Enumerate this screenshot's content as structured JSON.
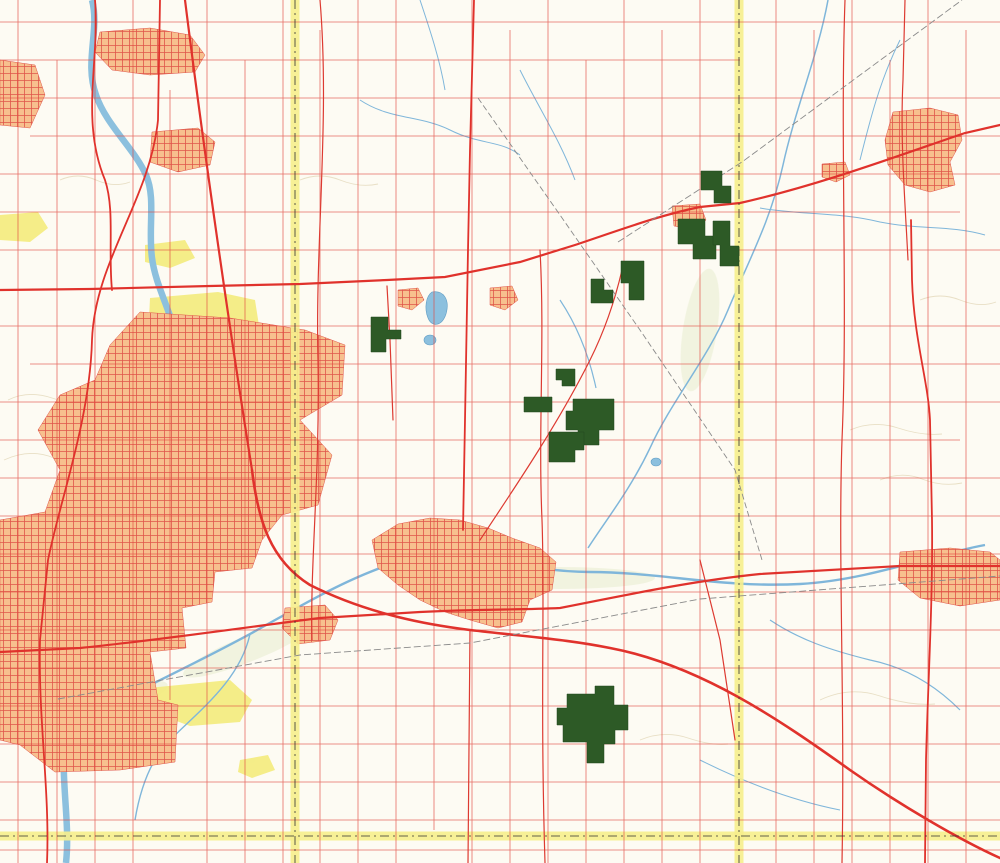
{
  "map": {
    "colors": {
      "arrow_fill": "#b7d455",
      "arrow_text": "#2d7a1e",
      "tract_fill": "#2d5a26",
      "county_band": "#f6ee8c",
      "road_minor": "#e2463e",
      "urban": "#f7c08e",
      "water": "#7fb6da",
      "park": "#f4ec7f",
      "interstate_blue": "#1d7fc4",
      "interstate_red": "#d6362b"
    },
    "arrows": [
      {
        "id": "tracts-40-48",
        "label": "Tracts 40-48",
        "x1": 520,
        "y1": 162,
        "x2": 733,
        "y2": 252,
        "lx": 597,
        "ly": 193,
        "rot": 23
      },
      {
        "id": "tracts-33-39",
        "label": "Tracts 33-39",
        "x1": 452,
        "y1": 192,
        "x2": 598,
        "y2": 283,
        "lx": 504,
        "ly": 226,
        "rot": 32
      },
      {
        "id": "tracts-30-32",
        "label": "Tracts 30-32",
        "x1": 212,
        "y1": 328,
        "x2": 548,
        "y2": 338,
        "lx": 296,
        "ly": 334,
        "rot": 1.5
      },
      {
        "id": "tracts-15-29",
        "label": "Tracts 15-29",
        "x1": 430,
        "y1": 302,
        "x2": 557,
        "y2": 400,
        "lx": 474,
        "ly": 341,
        "rot": 38
      },
      {
        "id": "auction",
        "label": "Auction",
        "x1": 352,
        "y1": 708,
        "x2": 483,
        "y2": 576,
        "lx": 401,
        "ly": 654,
        "rot": -45,
        "big": true
      },
      {
        "id": "tracts-1-14",
        "label": "Tracts 1-14",
        "x1": 406,
        "y1": 699,
        "x2": 560,
        "y2": 706,
        "lx": 463,
        "ly": 702,
        "rot": 2
      }
    ],
    "towns": [
      {
        "t": "Rockton",
        "x": 173,
        "y": 54,
        "c": "town"
      },
      {
        "t": "Roscoe",
        "x": 176,
        "y": 150,
        "c": "town"
      },
      {
        "t": "Morehaven",
        "x": 139,
        "y": 131,
        "c": "town-sm"
      },
      {
        "t": "Argyle",
        "x": 308,
        "y": 301,
        "c": "town-sm"
      },
      {
        "t": "Caledonia",
        "x": 387,
        "y": 276,
        "c": "town-big"
      },
      {
        "t": "Poplar Grove",
        "x": 501,
        "y": 281,
        "c": "town-sm"
      },
      {
        "t": "Capron",
        "x": 684,
        "y": 208,
        "c": "town-big"
      },
      {
        "t": "Harvard",
        "x": 947,
        "y": 123,
        "c": "town-md"
      },
      {
        "t": "Chemung",
        "x": 839,
        "y": 160,
        "c": "town-sm"
      },
      {
        "t": "Lawrence",
        "x": 880,
        "y": 99,
        "c": "town-sm"
      },
      {
        "t": "Machesney\nPark",
        "x": 90,
        "y": 336,
        "c": "town-md"
      },
      {
        "t": "Loves Park",
        "x": 97,
        "y": 401,
        "c": "town-md"
      },
      {
        "t": "ROCKFORD",
        "x": 67,
        "y": 530,
        "c": "city"
      },
      {
        "t": "Belvidere",
        "x": 442,
        "y": 531,
        "c": "city-sans"
      },
      {
        "t": "Cherry Valley",
        "x": 306,
        "y": 622,
        "c": "town-md"
      },
      {
        "t": "New\nMilford",
        "x": 55,
        "y": 737,
        "c": "town-md"
      },
      {
        "t": "Kishwaukee\nGlen",
        "x": 154,
        "y": 741,
        "c": "town-sm"
      },
      {
        "t": "Morristown",
        "x": 88,
        "y": 780,
        "c": "town-sm"
      },
      {
        "t": "Garden\nPrairie",
        "x": 727,
        "y": 588,
        "c": "town-sm"
      },
      {
        "t": "Camp\nEpworth",
        "x": 644,
        "y": 589,
        "c": "town-sm"
      },
      {
        "t": "Marengo",
        "x": 961,
        "y": 585,
        "c": "town-md"
      },
      {
        "t": "Russellville",
        "x": 608,
        "y": 390,
        "c": "micro"
      },
      {
        "t": "Blaine",
        "x": 566,
        "y": 77,
        "c": "micro"
      },
      {
        "t": "Perryville",
        "x": 235,
        "y": 658,
        "c": "micro"
      }
    ],
    "townships": [
      {
        "t": "ROSCOE",
        "x": 238,
        "y": 60
      },
      {
        "t": "MANCHESTER",
        "x": 425,
        "y": 45
      },
      {
        "t": "LEROY",
        "x": 628,
        "y": 63
      },
      {
        "t": "CHEMUNG",
        "x": 862,
        "y": 50
      },
      {
        "t": "CALEDONIA",
        "x": 376,
        "y": 231
      },
      {
        "t": "POPLAR\nGROVE",
        "x": 500,
        "y": 253
      },
      {
        "t": "DUNHAM",
        "x": 865,
        "y": 282
      },
      {
        "t": "HARLEM",
        "x": 168,
        "y": 271
      },
      {
        "t": "ROCKFORD",
        "x": 109,
        "y": 431
      },
      {
        "t": "BELVIDERE",
        "x": 448,
        "y": 503
      },
      {
        "t": "BONUS",
        "x": 637,
        "y": 493
      },
      {
        "t": "MARENGO",
        "x": 840,
        "y": 477
      },
      {
        "t": "CHERRY",
        "x": 127,
        "y": 688
      },
      {
        "t": "VALLEY",
        "x": 229,
        "y": 688
      },
      {
        "t": "SPRING",
        "x": 643,
        "y": 682
      },
      {
        "t": "RILEY",
        "x": 832,
        "y": 682
      },
      {
        "t": "BOONE",
        "x": 677,
        "y": 284
      }
    ],
    "counties": [
      {
        "t": "WINNEBAGO CO",
        "x": 240,
        "y": 832,
        "r": 0
      },
      {
        "t": "OGLE CO",
        "x": 227,
        "y": 844,
        "r": 0
      },
      {
        "t": "BOONE CO",
        "x": 352,
        "y": 831,
        "r": 0
      },
      {
        "t": "DE KALB CO",
        "x": 353,
        "y": 843,
        "r": 0
      },
      {
        "t": "DE KALB CO",
        "x": 747,
        "y": 843,
        "r": 0
      },
      {
        "t": "WINNEBAGO CO",
        "x": 288,
        "y": 40,
        "r": 90
      },
      {
        "t": "BOONE CO",
        "x": 304,
        "y": 36,
        "r": 90
      },
      {
        "t": "WINNEBAGO CO",
        "x": 290,
        "y": 680,
        "r": 90
      },
      {
        "t": "BOONE CO",
        "x": 304,
        "y": 678,
        "r": 90
      },
      {
        "t": "BOONE CO",
        "x": 732,
        "y": 22,
        "r": 90
      },
      {
        "t": "MC HENRY CO",
        "x": 748,
        "y": 26,
        "r": 90
      },
      {
        "t": "BOONE CO",
        "x": 736,
        "y": 806,
        "r": 90
      },
      {
        "t": "MC HENRY CO",
        "x": 750,
        "y": 807,
        "r": 90
      }
    ],
    "road_labels": [
      {
        "t": "MANCHESTER RD",
        "x": 489,
        "y": 14
      },
      {
        "t": "COON TRAIL RD",
        "x": 578,
        "y": 12
      },
      {
        "t": "RANDALL RD",
        "x": 690,
        "y": 50
      },
      {
        "t": "BLAINE RD",
        "x": 650,
        "y": 92
      },
      {
        "t": "ROCKTON RD",
        "x": 407,
        "y": 58
      },
      {
        "t": "ELEVATOR RD",
        "x": 259,
        "y": 124
      },
      {
        "t": "WEST LANE RD",
        "x": 262,
        "y": 272
      },
      {
        "t": "CEMETERY RD",
        "x": 713,
        "y": 218
      },
      {
        "t": "BUNKER HILL RD",
        "x": 837,
        "y": 308
      },
      {
        "t": "DUNHAM RD",
        "x": 758,
        "y": 353
      },
      {
        "t": "GRANGE HALL RD",
        "x": 612,
        "y": 365
      },
      {
        "t": "ORTH RD",
        "x": 698,
        "y": 384
      },
      {
        "t": "WOODSTOCK RD",
        "x": 543,
        "y": 430
      },
      {
        "t": "SQUAW PRAIRIE RD",
        "x": 600,
        "y": 478
      },
      {
        "t": "CHRYSLER DR",
        "x": 692,
        "y": 603
      },
      {
        "t": "FERN HILL RD",
        "x": 708,
        "y": 651
      },
      {
        "t": "JACKSON RD",
        "x": 760,
        "y": 666
      },
      {
        "t": "HUBER RD",
        "x": 639,
        "y": 718
      },
      {
        "t": "W ANTHONY RD",
        "x": 930,
        "y": 739
      },
      {
        "t": "HARMONY RD",
        "x": 763,
        "y": 758
      },
      {
        "t": "ENGELSON RD",
        "x": 680,
        "y": 776
      },
      {
        "t": "BLOODS POINT RD",
        "x": 476,
        "y": 776
      },
      {
        "t": "POOLE RD",
        "x": 430,
        "y": 747
      },
      {
        "t": "DAVIS SCHOOL RD",
        "x": 515,
        "y": 793
      },
      {
        "t": "HARTMAN RD",
        "x": 838,
        "y": 790
      },
      {
        "t": "FLORA CHURCH RD",
        "x": 358,
        "y": 815
      },
      {
        "t": "POPLAR RD",
        "x": 580,
        "y": 830
      },
      {
        "t": "POPLAR RD",
        "x": 893,
        "y": 832
      },
      {
        "t": "AIRPORT RD",
        "x": 893,
        "y": 179
      },
      {
        "t": "HANER RD",
        "x": 864,
        "y": 147
      },
      {
        "t": "TOWN LINE RD",
        "x": 298,
        "y": 107,
        "r": 90
      },
      {
        "t": "POPLAR GROVE RD",
        "x": 527,
        "y": 185,
        "r": 90
      },
      {
        "t": "GENOA RD",
        "x": 548,
        "y": 678,
        "r": 90
      },
      {
        "t": "COUNTY LINE RD",
        "x": 736,
        "y": 713,
        "r": 90
      },
      {
        "t": "UNION PACIFIC",
        "x": 163,
        "y": 646,
        "r": -8
      }
    ],
    "water_labels": [
      {
        "t": "Piscasaw Creek",
        "x": 766,
        "y": 196,
        "r": -62
      },
      {
        "t": "Rush Creek",
        "x": 851,
        "y": 390,
        "r": -72
      },
      {
        "t": "Candlewick\nLake",
        "x": 459,
        "y": 304
      },
      {
        "t": "County\nLake",
        "x": 430,
        "y": 353
      },
      {
        "t": "River",
        "x": 578,
        "y": 572
      }
    ],
    "place_labels": [
      {
        "t": "ROCK CUT\nSTATE PARK",
        "x": 203,
        "y": 306
      },
      {
        "t": "KISHWAUKEE\nFOREST PRESERVE",
        "x": 210,
        "y": 743
      },
      {
        "t": "ATWOOD HOMESTEAD\nFOREST PRESERVE",
        "x": 38,
        "y": 233
      },
      {
        "t": "KIESELBURG\nFOREST PRESERVE",
        "x": 164,
        "y": 257
      },
      {
        "t": "Hutchins\nPark",
        "x": 24,
        "y": 258
      },
      {
        "t": "Latham\nPark",
        "x": 27,
        "y": 285
      },
      {
        "t": "Pierce\nLake",
        "x": 204,
        "y": 327
      },
      {
        "t": "The Time\nMuseum",
        "x": 281,
        "y": 534
      },
      {
        "t": "Ida Belle Farm\nLanding Strip",
        "x": 197,
        "y": 192
      },
      {
        "t": "Landing\nStrip",
        "x": 687,
        "y": 25
      },
      {
        "t": "Landing\nStrip",
        "x": 922,
        "y": 754
      },
      {
        "t": "Belvidere\nAirport",
        "x": 506,
        "y": 392
      },
      {
        "t": "Dacy\nAirport",
        "x": 880,
        "y": 192
      }
    ],
    "icons": [
      {
        "g": "✈",
        "x": 497,
        "y": 383,
        "n": "airport-icon"
      },
      {
        "g": "✈",
        "x": 876,
        "y": 184,
        "n": "airport-icon"
      },
      {
        "g": "✈",
        "x": 706,
        "y": 566,
        "n": "airport-icon"
      }
    ],
    "shields": [
      {
        "kind": "interstate",
        "num": "90",
        "x": 252,
        "y": 491,
        "s": 1
      },
      {
        "kind": "interstate",
        "num": "90",
        "x": 627,
        "y": 651,
        "s": 1.05
      },
      {
        "kind": "interstate",
        "num": "39",
        "x": 195,
        "y": 15,
        "s": 0.55
      },
      {
        "kind": "interstate",
        "num": "90",
        "x": 195,
        "y": 37,
        "s": 0.55
      },
      {
        "kind": "interstate",
        "num": "39",
        "x": 236,
        "y": 234,
        "s": 0.5
      },
      {
        "kind": "interstate",
        "num": "90",
        "x": 238,
        "y": 248,
        "s": 0.5
      },
      {
        "kind": "interstate",
        "num": "39",
        "x": 250,
        "y": 536,
        "s": 0.5
      },
      {
        "kind": "interstate",
        "num": "90",
        "x": 250,
        "y": 548,
        "s": 0.5
      },
      {
        "kind": "interstate",
        "num": "39",
        "x": 137,
        "y": 755,
        "s": 0.5
      },
      {
        "kind": "us",
        "num": "51",
        "x": 196,
        "y": 57,
        "s": 0.62
      },
      {
        "kind": "us",
        "num": "51",
        "x": 242,
        "y": 263,
        "s": 0.6
      },
      {
        "kind": "us",
        "num": "51",
        "x": 251,
        "y": 561,
        "s": 0.6
      },
      {
        "kind": "us",
        "num": "51",
        "x": 137,
        "y": 771,
        "s": 0.6
      },
      {
        "kind": "us",
        "num": "20",
        "x": 393,
        "y": 612,
        "s": 1
      },
      {
        "kind": "us",
        "num": "20",
        "x": 343,
        "y": 521,
        "s": 0.7
      },
      {
        "kind": "us",
        "num": "20",
        "x": 705,
        "y": 577,
        "s": 0.8
      },
      {
        "kind": "us",
        "num": "20",
        "x": 218,
        "y": 658,
        "s": 0.6
      },
      {
        "kind": "us",
        "num": "20",
        "x": 968,
        "y": 803,
        "s": 0.6
      },
      {
        "kind": "oval",
        "num": "173",
        "x": 445,
        "y": 277,
        "s": 1
      },
      {
        "kind": "oval",
        "num": "173",
        "x": 722,
        "y": 200,
        "s": 1
      },
      {
        "kind": "oval",
        "num": "173",
        "x": 975,
        "y": 130,
        "s": 1
      },
      {
        "kind": "oval",
        "num": "173",
        "x": 128,
        "y": 288,
        "s": 1
      },
      {
        "kind": "oval",
        "num": "76",
        "x": 470,
        "y": 230,
        "s": 0.9
      },
      {
        "kind": "oval",
        "num": "76",
        "x": 466,
        "y": 492,
        "s": 0.9
      },
      {
        "kind": "oval",
        "num": "251",
        "x": 158,
        "y": 207,
        "s": 0.95
      },
      {
        "kind": "oval",
        "num": "251",
        "x": 86,
        "y": 418,
        "s": 0.9
      },
      {
        "kind": "oval",
        "num": "251",
        "x": 45,
        "y": 632,
        "s": 0.9
      },
      {
        "kind": "oval",
        "num": "2",
        "x": 73,
        "y": 81,
        "s": 0.9
      },
      {
        "kind": "oval",
        "num": "75",
        "x": 62,
        "y": 33,
        "s": 0.85
      },
      {
        "kind": "oval",
        "num": "23",
        "x": 911,
        "y": 233,
        "s": 0.9
      },
      {
        "kind": "oval",
        "num": "23",
        "x": 930,
        "y": 401,
        "s": 0.9
      },
      {
        "kind": "oval",
        "num": "23",
        "x": 927,
        "y": 650,
        "s": 0.9
      },
      {
        "kind": "oval",
        "num": "23",
        "x": 875,
        "y": 821,
        "s": 0.9
      }
    ]
  }
}
